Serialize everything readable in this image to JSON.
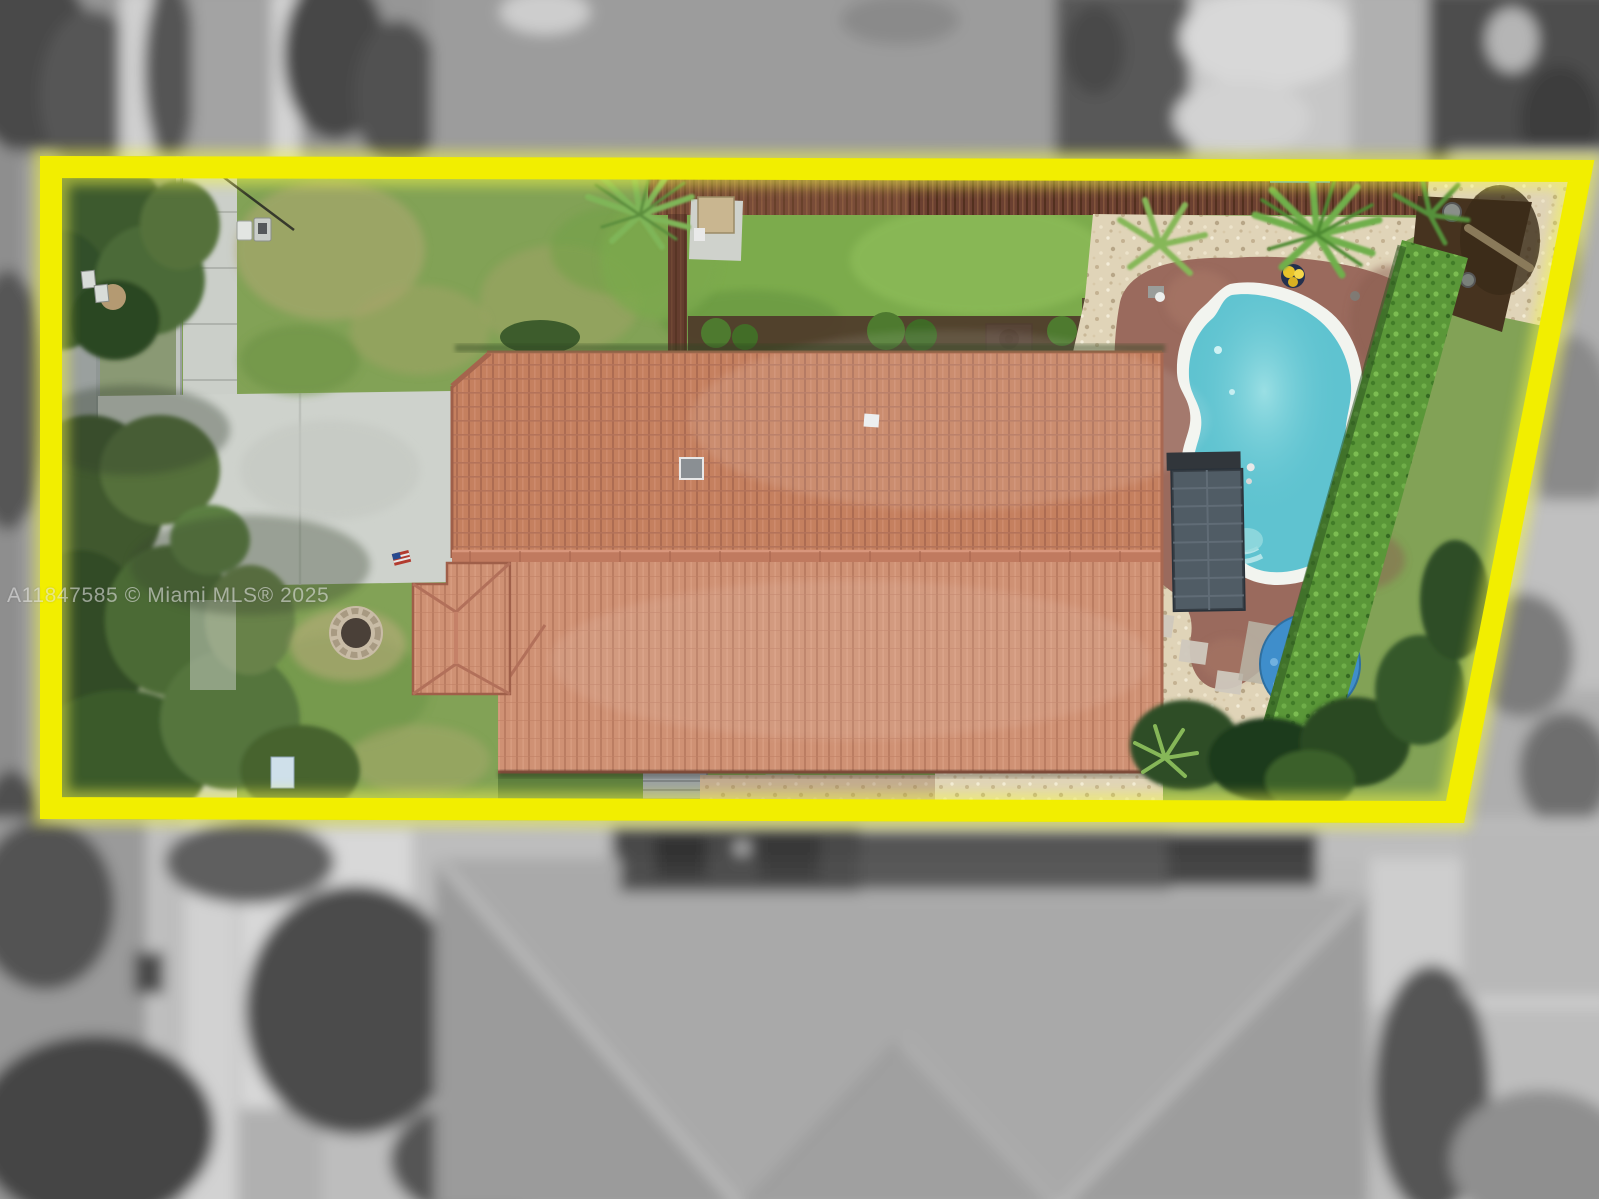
{
  "watermark": {
    "text": "A11847585 © Miami MLS® 2025"
  },
  "scene": {
    "colors": {
      "highlight": "#f2ee00",
      "highlight_glow": "#f6f94a",
      "roof_tile": "#c5805f",
      "roof_tile_lower": "#cf9174",
      "pool_water": "#5fc3d0",
      "pool_coping": "#f2f4ef",
      "pool_deck": "#9a6a5d",
      "lawn": "#82a256",
      "backyard_lawn": "#7cab4c",
      "gravel": "#e0d4b8",
      "hedge": "#5a9738",
      "umbrella": "#3f8ecb",
      "fence": "#6b4031",
      "road": "#9aa09e",
      "sidewalk": "#cbcfc9",
      "driveway": "#ced2cc",
      "mulch": "#4e392a",
      "solar_panel": "#46525c",
      "tree_dark": "#3c5a2d",
      "flag_red": "#b23b2e"
    }
  }
}
